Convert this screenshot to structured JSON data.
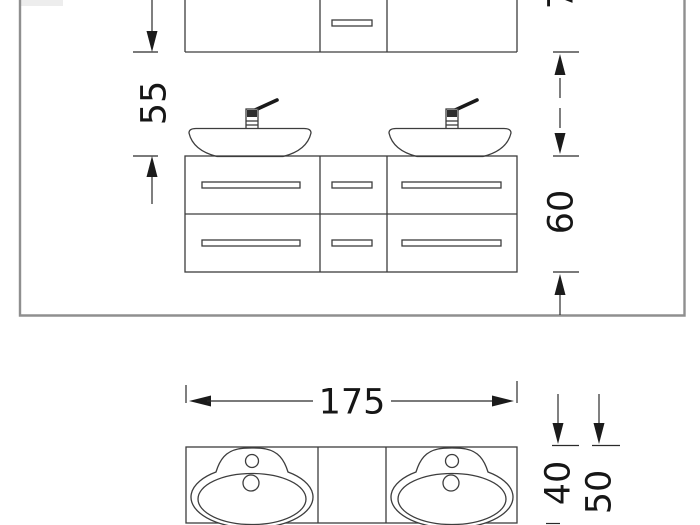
{
  "drawing": {
    "kind": "bathroom-vanity-technical-drawing",
    "colors": {
      "background": "#ffffff",
      "frame": "#8f8f8f",
      "line": "#3d3d3d",
      "dimension": "#2a2a2a",
      "text": "#161616"
    },
    "elevation": {
      "dim_gap": "55",
      "dim_vanity_height": "60",
      "dim_top_cropped": "70"
    },
    "plan": {
      "dim_width": "175",
      "dim_counter_depth": "40",
      "dim_total_depth": "50"
    }
  }
}
